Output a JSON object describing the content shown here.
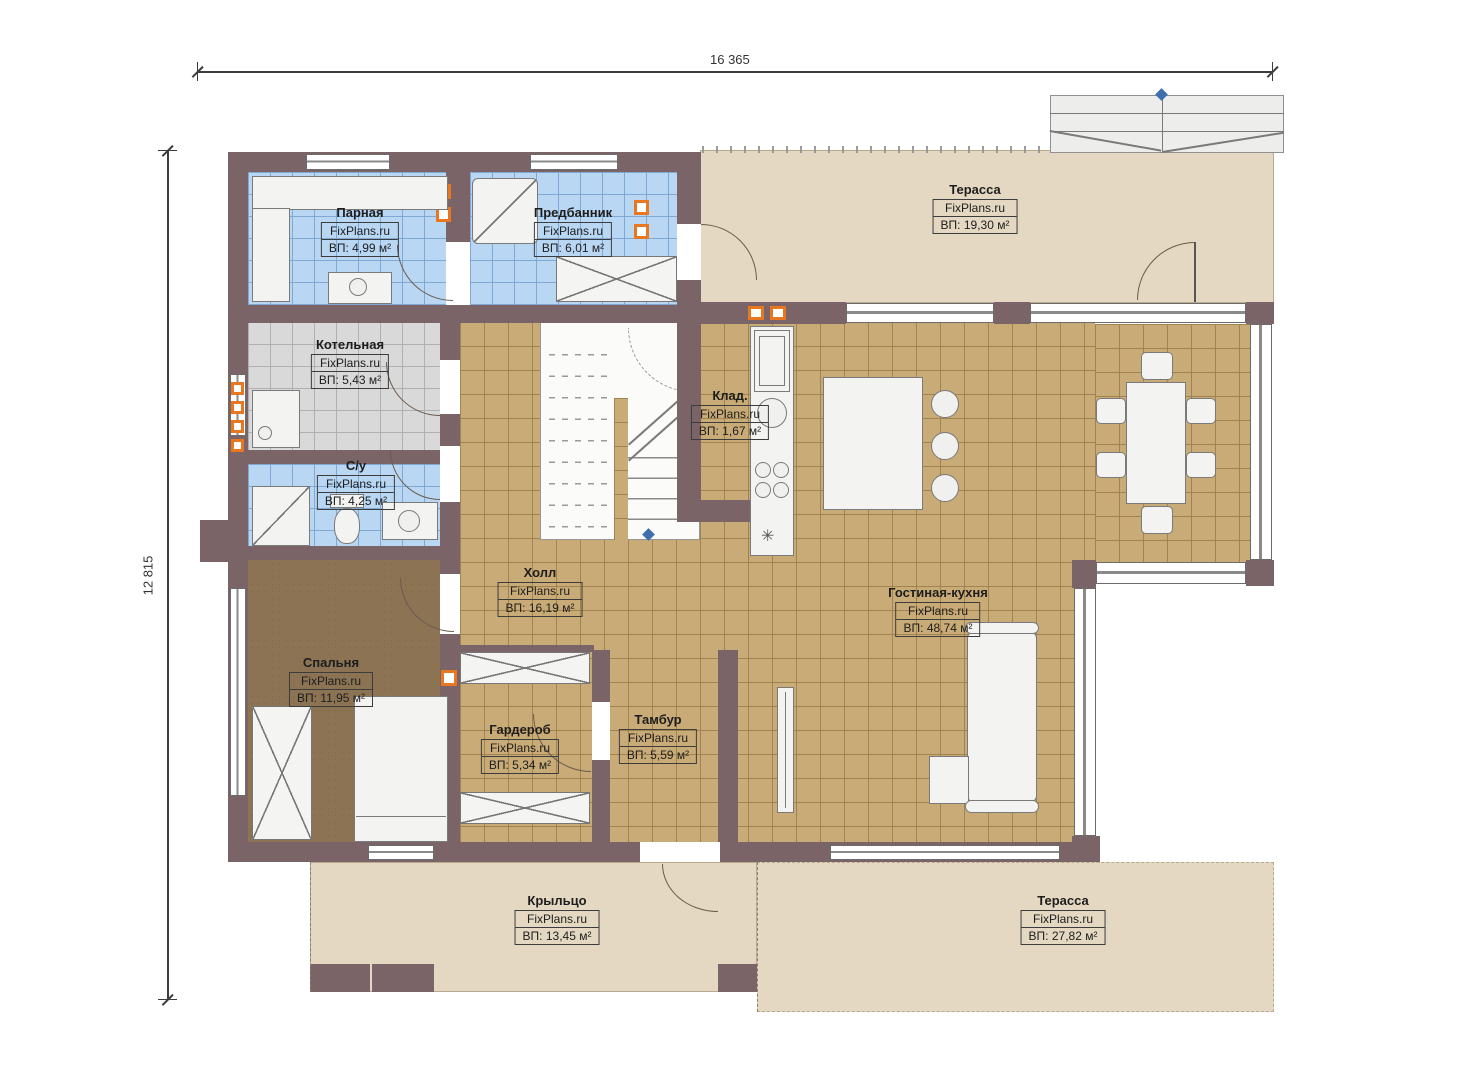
{
  "dimensions": {
    "top": "16 365",
    "left": "12 815"
  },
  "rooms": [
    {
      "id": "parnaya",
      "name": "Парная",
      "watermark": "FixPlans.ru",
      "area": "ВП: 4,99 м²"
    },
    {
      "id": "predbannik",
      "name": "Предбанник",
      "watermark": "FixPlans.ru",
      "area": "ВП: 6,01 м²"
    },
    {
      "id": "terrace-top",
      "name": "Терасса",
      "watermark": "FixPlans.ru",
      "area": "ВП: 19,30 м²"
    },
    {
      "id": "kotelnaya",
      "name": "Котельная",
      "watermark": "FixPlans.ru",
      "area": "ВП: 5,43 м²"
    },
    {
      "id": "kladovaya",
      "name": "Клад.",
      "watermark": "FixPlans.ru",
      "area": "ВП: 1,67 м²"
    },
    {
      "id": "sanuzel",
      "name": "С/у",
      "watermark": "FixPlans.ru",
      "area": "ВП: 4,25 м²"
    },
    {
      "id": "holl",
      "name": "Холл",
      "watermark": "FixPlans.ru",
      "area": "ВП: 16,19 м²"
    },
    {
      "id": "gostinaya",
      "name": "Гостиная-кухня",
      "watermark": "FixPlans.ru",
      "area": "ВП: 48,74 м²"
    },
    {
      "id": "spalnya",
      "name": "Спальня",
      "watermark": "FixPlans.ru",
      "area": "ВП: 11,95 м²"
    },
    {
      "id": "garderob",
      "name": "Гардероб",
      "watermark": "FixPlans.ru",
      "area": "ВП: 5,34 м²"
    },
    {
      "id": "tambur",
      "name": "Тамбур",
      "watermark": "FixPlans.ru",
      "area": "ВП: 5,59 м²"
    },
    {
      "id": "kryltso",
      "name": "Крыльцо",
      "watermark": "FixPlans.ru",
      "area": "ВП: 13,45 м²"
    },
    {
      "id": "terrace-bottom",
      "name": "Терасса",
      "watermark": "FixPlans.ru",
      "area": "ВП: 27,82 м²"
    }
  ],
  "colors": {
    "wall": "#7b6467",
    "tile_tan": "#c9ab77",
    "tile_blue": "#b9d7f3",
    "tile_gray": "#d9d9d9",
    "carpet": "#8c7354",
    "terrace": "#e5d8c2",
    "vent_orange": "#e87722",
    "marker_blue": "#3f6fae"
  }
}
